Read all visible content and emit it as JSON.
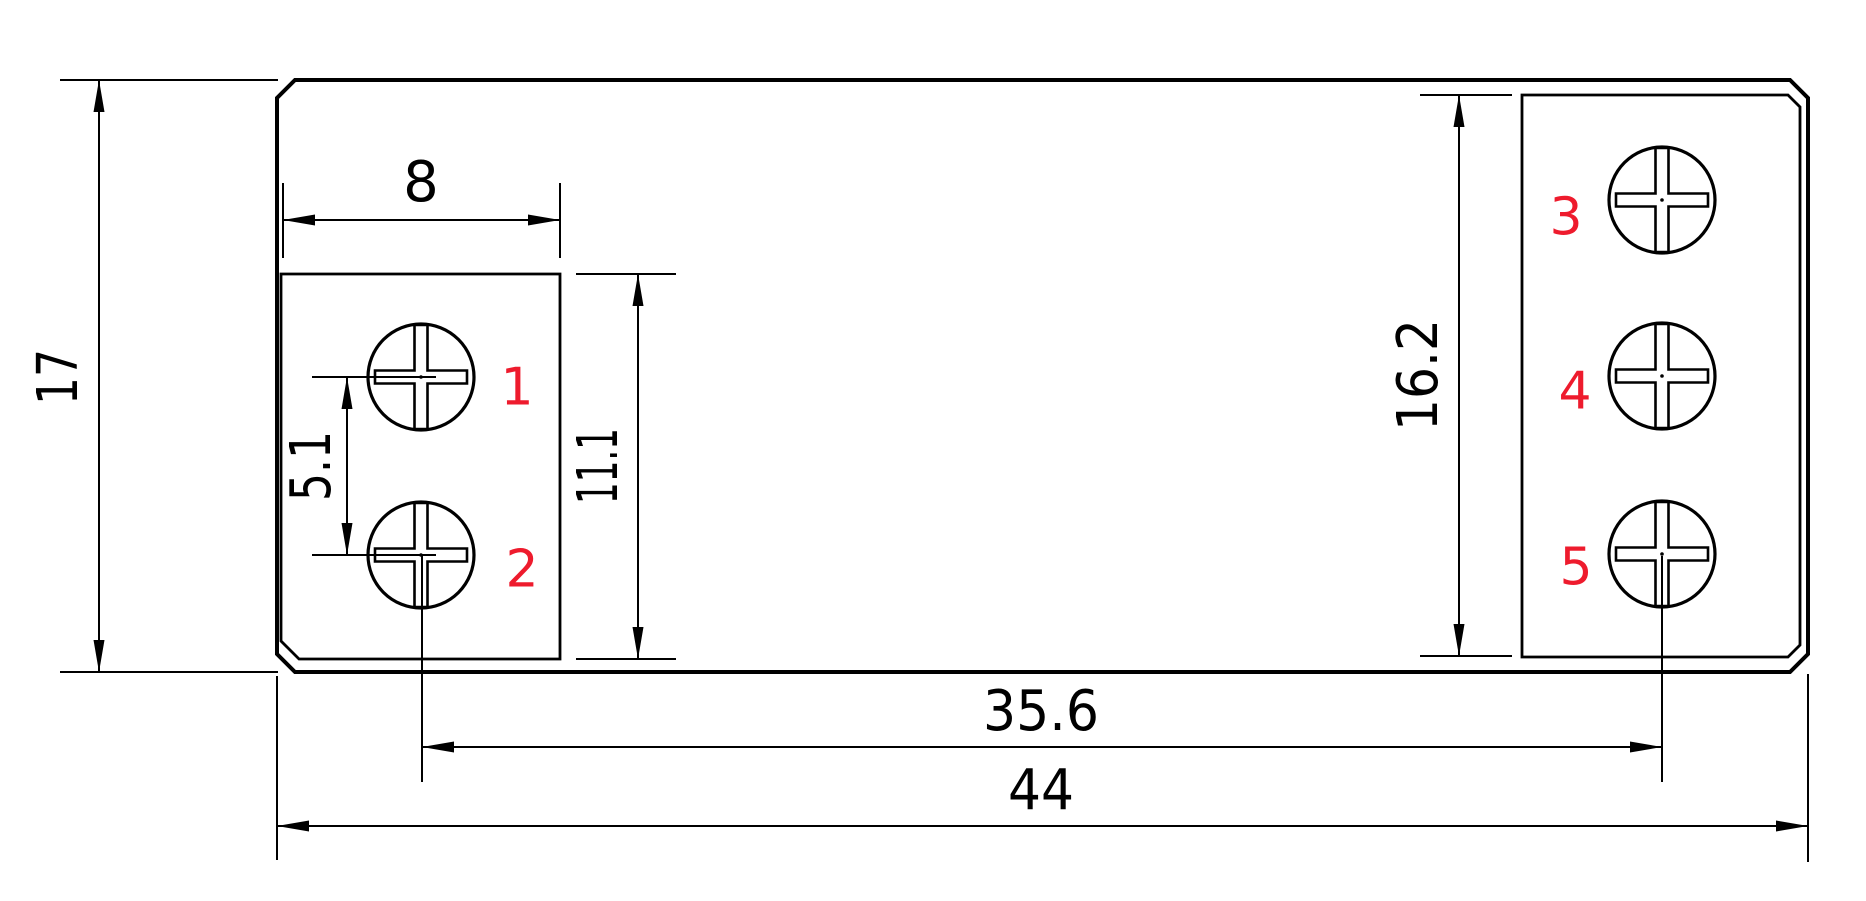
{
  "colors": {
    "background": "#ffffff",
    "line": "#000000",
    "terminal_red": "#ee1b2d"
  },
  "dims": {
    "overall_height": "17",
    "left_block_width": "8",
    "terminal_pitch": "5.1",
    "left_block_height": "11.1",
    "right_block_height": "16.2",
    "terminal_span": "35.6",
    "overall_width": "44"
  },
  "terminals": {
    "t1": "1",
    "t2": "2",
    "t3": "3",
    "t4": "4",
    "t5": "5"
  }
}
